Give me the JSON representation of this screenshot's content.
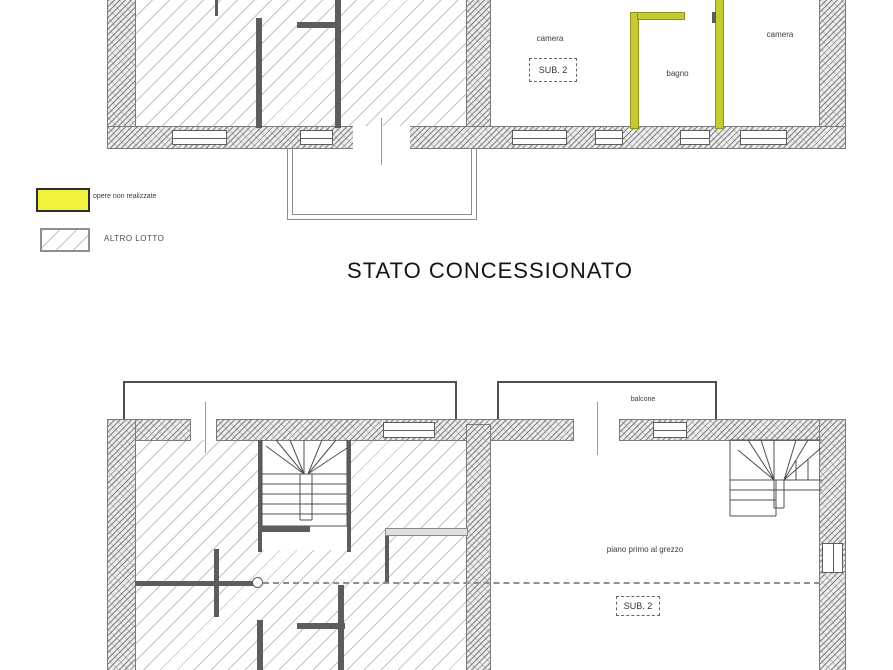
{
  "title": "STATO CONCESSIONATO",
  "legend": {
    "items": [
      {
        "label": "opere non realizzate",
        "swatch": "yellow",
        "color": "#f2f23c"
      },
      {
        "label": "ALTRO LOTTO",
        "swatch": "hatched"
      }
    ]
  },
  "plan_top": {
    "rooms": [
      {
        "label": "camera"
      },
      {
        "label": "bagno"
      },
      {
        "label": "camera"
      }
    ],
    "sub_badge": "SUB. 2"
  },
  "plan_bottom": {
    "balcony_label": "balcone",
    "area_label": "piano primo al grezzo",
    "sub_badge": "SUB. 2"
  },
  "colors": {
    "unrealized_works_yellow": "#c6cb35",
    "legend_yellow": "#f2f23c",
    "hatch_gray": "#c2c2c2",
    "wall_dark": "#5d5d5d",
    "background": "#ffffff"
  }
}
